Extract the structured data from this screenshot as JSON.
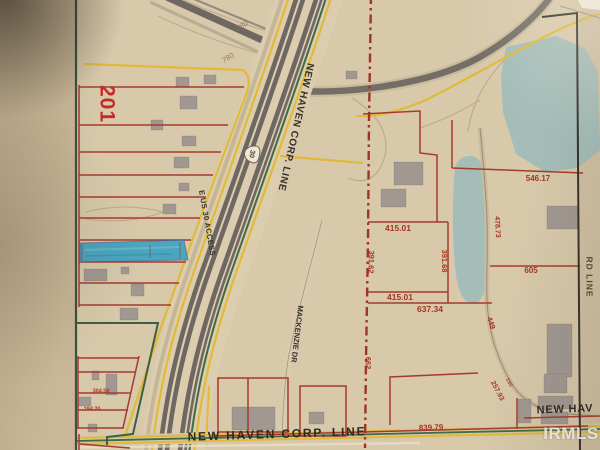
{
  "map": {
    "region_label": "201",
    "roads": {
      "corp_line_diagonal": "NEW HAVEN CORP. LINE",
      "corp_line_bottom": "NEW HAVEN CORP. LINE",
      "corp_line_right_fragment": "NEW HAV",
      "access_road": "E US 30 ACCESS",
      "mackenzie_dr": "MACKENZIE DR",
      "right_edge_road": "RD LINE",
      "us_route_shield": "30"
    },
    "contour_labels": [
      "780",
      "780"
    ],
    "measurements": [
      {
        "text": "546.17"
      },
      {
        "text": "478.73"
      },
      {
        "text": "415.01"
      },
      {
        "text": "391.68"
      },
      {
        "text": "391.62"
      },
      {
        "text": "415.01"
      },
      {
        "text": "637.34"
      },
      {
        "text": "605"
      },
      {
        "text": "449"
      },
      {
        "text": "257.93"
      },
      {
        "text": "190"
      },
      {
        "text": "662"
      },
      {
        "text": "839.79"
      },
      {
        "text": "304.50"
      },
      {
        "text": "194.20"
      }
    ],
    "colors": {
      "paper": "#d8c9ab",
      "parcel_red": "#a63b2c",
      "boundary_yellow": "#e0ba38",
      "corp_green": "#3f6b4a",
      "water": "#a4bdb8",
      "highlight_blue": "#3fa3c0",
      "road_gray": "#6f6862"
    }
  },
  "watermark": "IRMLS"
}
